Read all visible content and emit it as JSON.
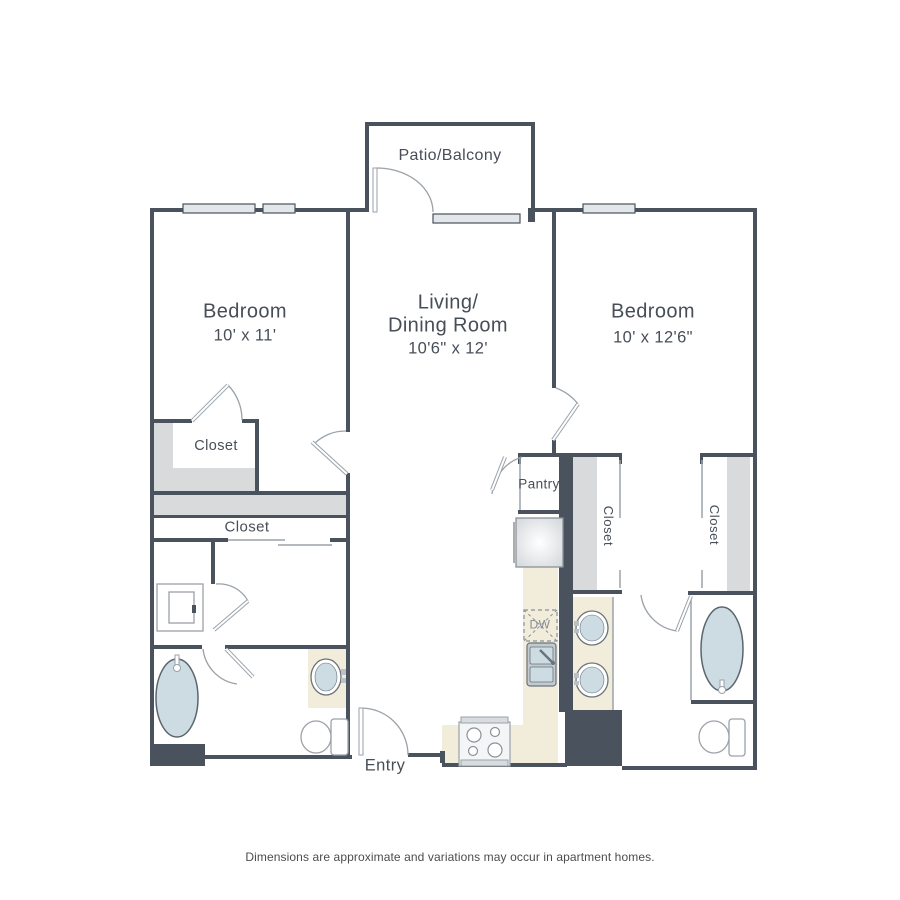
{
  "plan_title": "Two bedroom apartment floor plan",
  "rooms": {
    "patio": {
      "label": "Patio/Balcony"
    },
    "bedroom_left": {
      "label": "Bedroom",
      "dims": "10' x 11'"
    },
    "living": {
      "line1": "Living/",
      "line2": "Dining Room",
      "dims": "10'6\" x 12'"
    },
    "bedroom_right": {
      "label": "Bedroom",
      "dims": "10' x 12'6\""
    },
    "pantry": {
      "label": "Pantry"
    },
    "entry": {
      "label": "Entry"
    }
  },
  "closets": {
    "bedroom_left_closet": {
      "label": "Closet"
    },
    "hall_closet": {
      "label": "Closet"
    },
    "right_closet_a": {
      "label": "Closet"
    },
    "right_closet_b": {
      "label": "Closet"
    }
  },
  "appliances": {
    "dishwasher_label": "DW"
  },
  "footer": {
    "disclaimer": "Dimensions are approximate and variations may occur in apartment homes."
  },
  "colors": {
    "wall": "#4a525d",
    "thin_line": "#9aa2a9",
    "closet_shade": "#d8dadc",
    "counter": "#f1edda",
    "fixture_fill": "#ccdce2",
    "window_fill": "#e3e7e9",
    "text": "#474e57"
  }
}
